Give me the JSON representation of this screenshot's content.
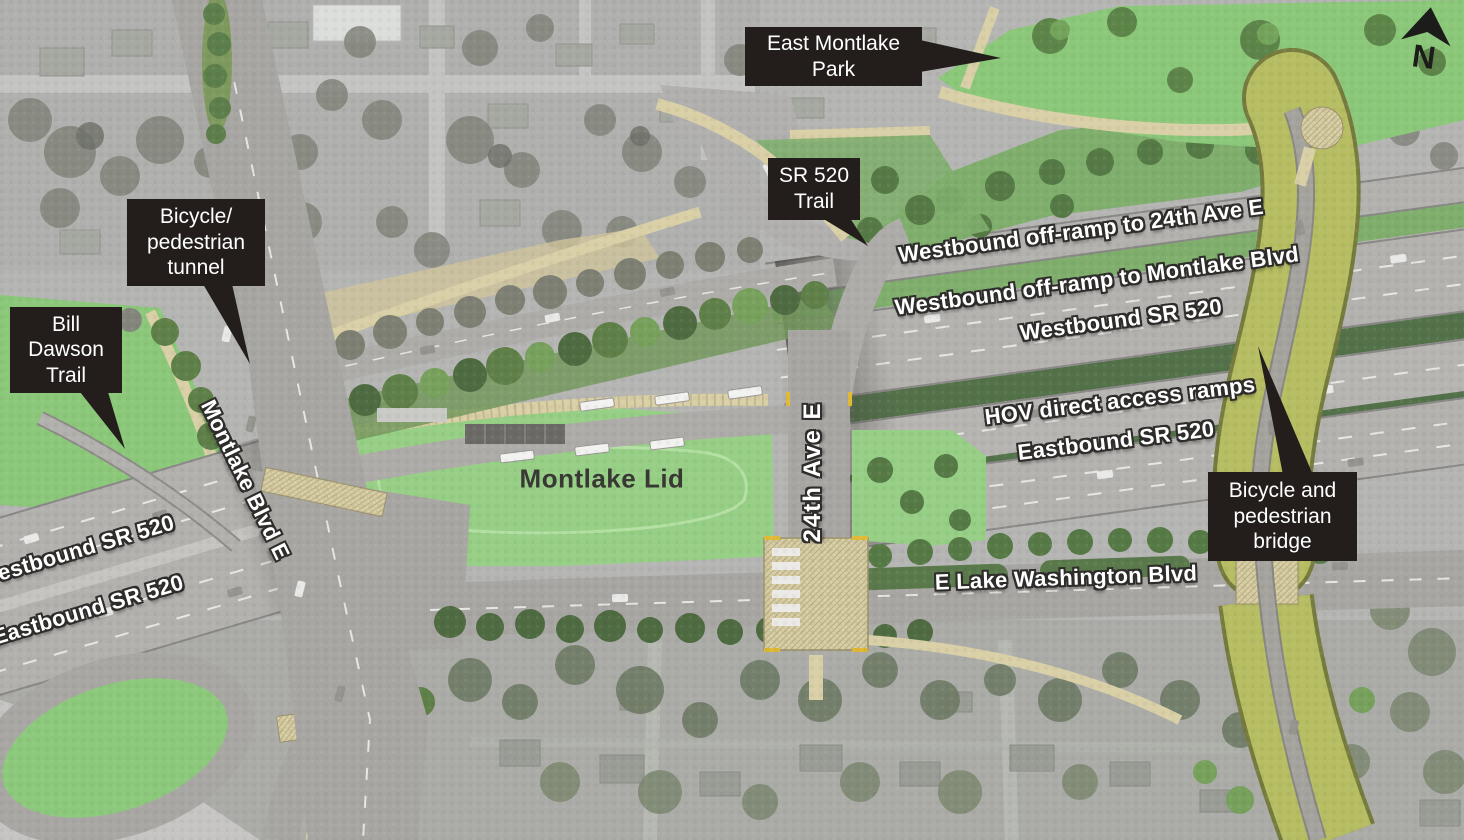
{
  "canvas": {
    "width": 1464,
    "height": 840
  },
  "compass": {
    "letter": "N"
  },
  "callouts": [
    {
      "id": "east-montlake-park",
      "text": "East Montlake\nPark"
    },
    {
      "id": "sr-520-trail",
      "text": "SR 520\nTrail"
    },
    {
      "id": "bicycle-pedestrian-tunnel",
      "text": "Bicycle/\npedestrian\ntunnel"
    },
    {
      "id": "bill-dawson-trail",
      "text": "Bill\nDawson\nTrail"
    },
    {
      "id": "bicycle-pedestrian-bridge",
      "text": "Bicycle and\npedestrian\nbridge"
    }
  ],
  "road_labels": [
    {
      "id": "wb-offramp-24th",
      "text": "Westbound off-ramp to 24th Ave E"
    },
    {
      "id": "wb-offramp-montlake",
      "text": "Westbound off-ramp to Montlake Blvd"
    },
    {
      "id": "wb-sr520",
      "text": "Westbound SR 520"
    },
    {
      "id": "hov-direct-access",
      "text": "HOV direct access ramps"
    },
    {
      "id": "eb-sr520",
      "text": "Eastbound SR 520"
    },
    {
      "id": "24th-ave-e",
      "text": "24th Ave E"
    },
    {
      "id": "montlake-blvd-e",
      "text": "Montlake Blvd E"
    },
    {
      "id": "e-lake-washington-blvd",
      "text": "E Lake Washington Blvd"
    },
    {
      "id": "wb-sr520-west",
      "text": "Westbound SR 520"
    },
    {
      "id": "eb-sr520-west",
      "text": "Eastbound SR 520"
    }
  ],
  "area_labels": [
    {
      "id": "montlake-lid",
      "text": "Montlake Lid"
    }
  ],
  "colors": {
    "callout_bg": "#231e1c",
    "callout_text": "#ffffff",
    "road_label_text": "#ffffff",
    "road_label_outline": "#2e2d2b",
    "lid_green": "#96cf85",
    "park_green": "#8bc87a",
    "slope_green": "#7fae6d",
    "median_green": "#54724a",
    "bridge_olive": "#b6bd62",
    "highway_gray": "#b3b1ad",
    "local_road_gray": "#a8a6a2",
    "path_tan": "#d9d0a7",
    "area_label_text": "#3a3835"
  }
}
